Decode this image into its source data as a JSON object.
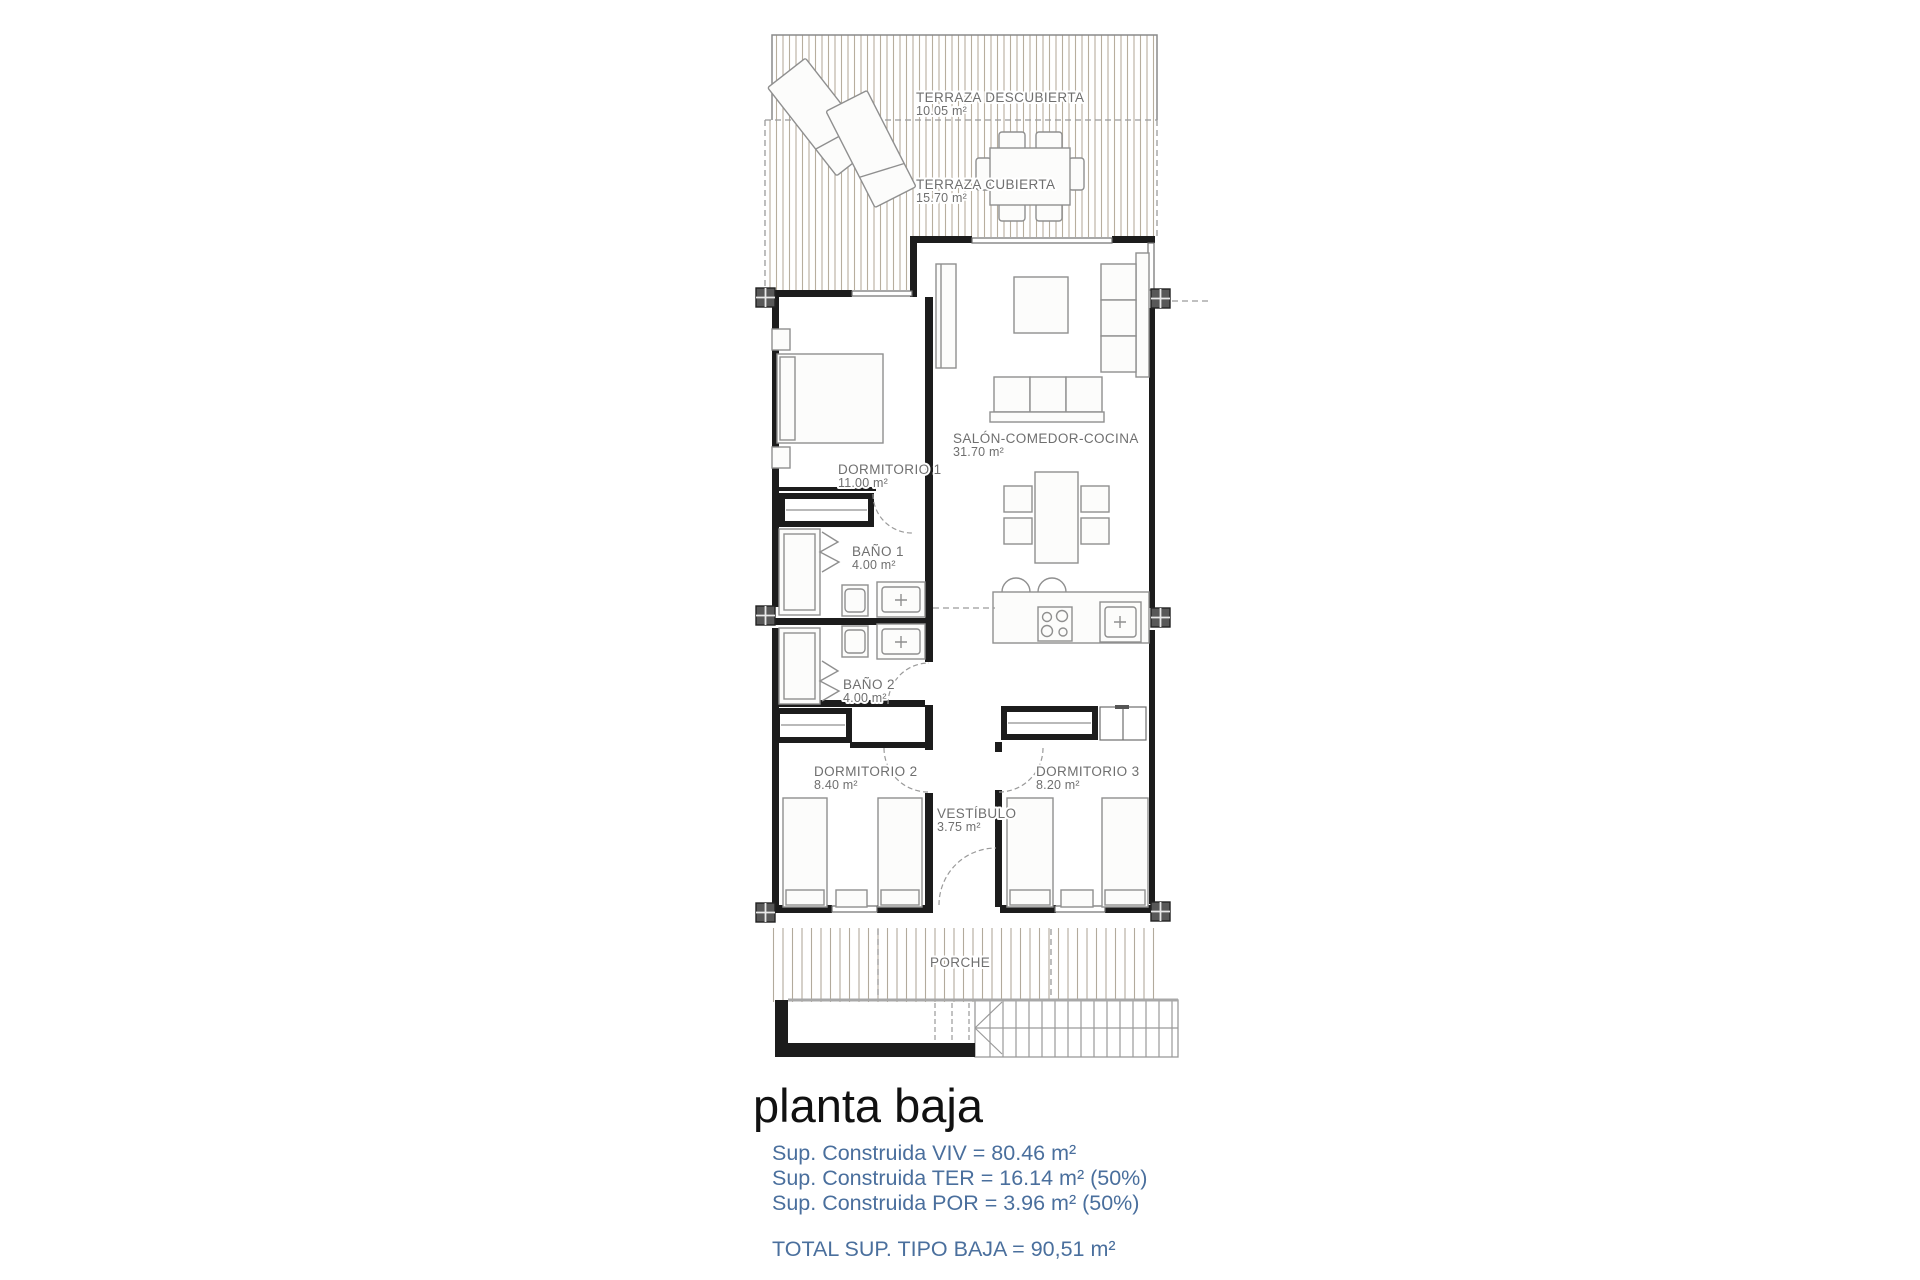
{
  "colors": {
    "wall": "#1c1c1c",
    "hatch_line": "#b7ae9e",
    "furniture_line": "#8f8f8f",
    "label_text": "#6f6f6f",
    "dashed_line": "#9a9a9a",
    "pillar_fill": "#585858",
    "summary_text": "#4a6f9d",
    "title_text": "#111111"
  },
  "labels": {
    "terraza_descubierta": {
      "name": "TERRAZA DESCUBIERTA",
      "area": "10.05 m²"
    },
    "terraza_cubierta": {
      "name": "TERRAZA CUBIERTA",
      "area": "15.70 m²"
    },
    "salon": {
      "name": "SALÓN-COMEDOR-COCINA",
      "area": "31.70 m²"
    },
    "dormitorio1": {
      "name": "DORMITORIO 1",
      "area": "11.00 m²"
    },
    "bano1": {
      "name": "BAÑO 1",
      "area": "4.00 m²"
    },
    "bano2": {
      "name": "BAÑO 2",
      "area": "4.00 m²"
    },
    "dormitorio2": {
      "name": "DORMITORIO 2",
      "area": "8.40 m²"
    },
    "dormitorio3": {
      "name": "DORMITORIO 3",
      "area": "8.20 m²"
    },
    "vestibulo": {
      "name": "VESTÍBULO",
      "area": "3.75 m²"
    },
    "porche": {
      "name": "PORCHE"
    }
  },
  "footer": {
    "title": "planta baja",
    "lines": [
      "Sup. Construida VIV = 80.46 m²",
      "Sup. Construida TER = 16.14 m² (50%)",
      "Sup. Construida POR = 3.96 m² (50%)"
    ],
    "total": "TOTAL SUP. TIPO BAJA = 90,51 m²"
  }
}
